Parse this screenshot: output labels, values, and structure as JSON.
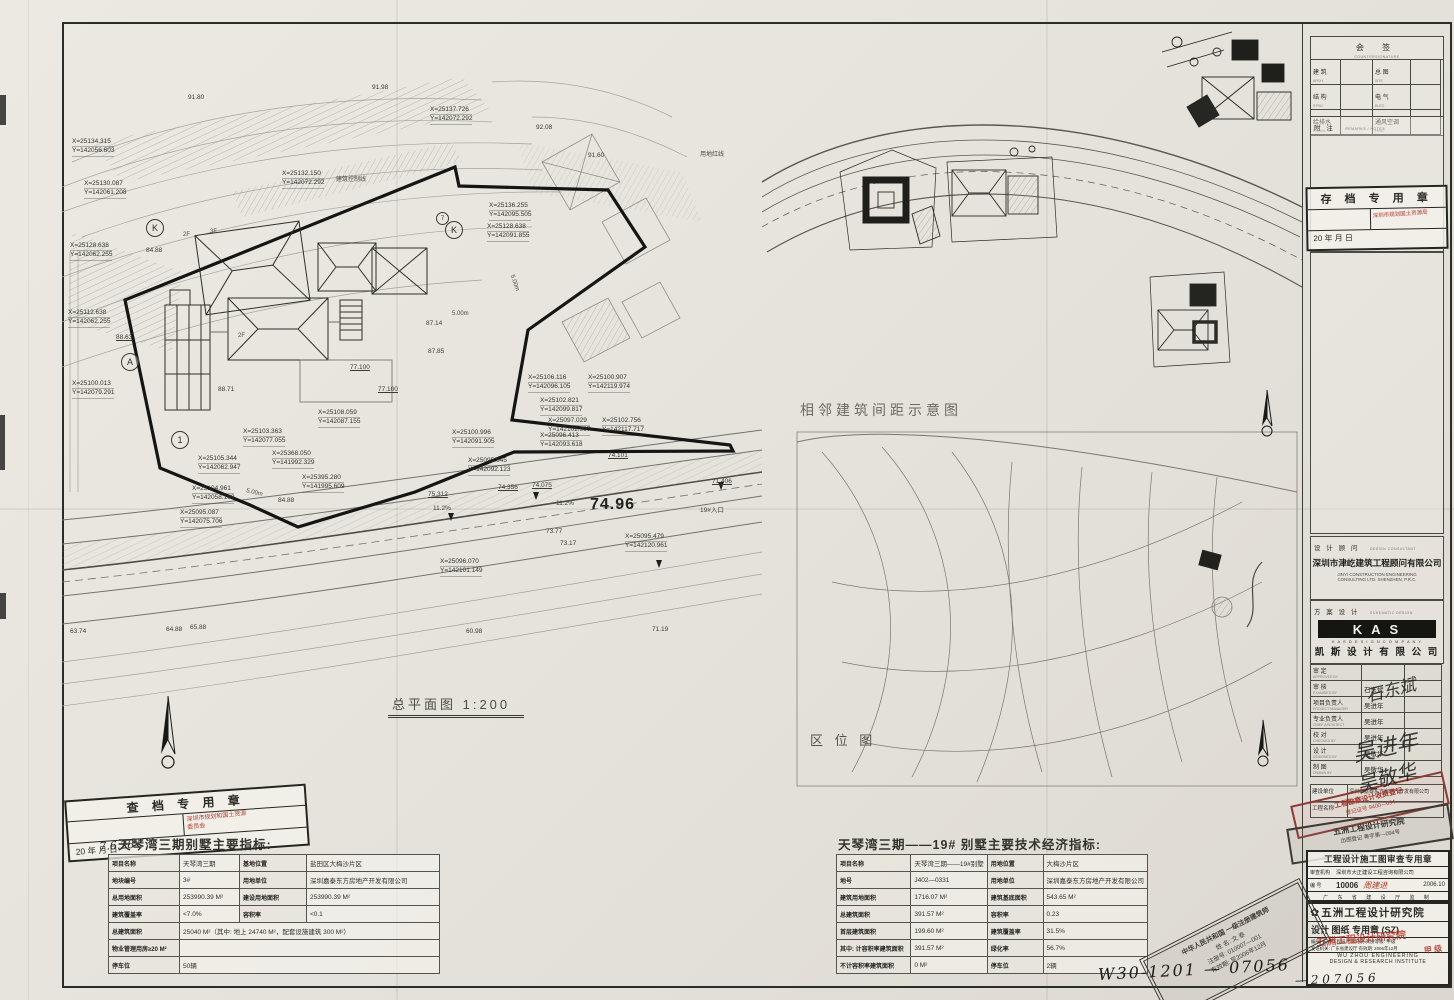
{
  "sheet": {
    "scale_label": "总平面图  1:200",
    "handwritten_drawing_no": "W30-1201 — 07056",
    "spacing_diagram_label": "相邻建筑间距示意图",
    "location_map_label": "区 位 图"
  },
  "main_plan": {
    "coord_labels": [
      {
        "x": 430,
        "y": 106,
        "l1": "X=25137.726",
        "l2": "Y=142072.292"
      },
      {
        "x": 72,
        "y": 138,
        "l1": "X=25134.315",
        "l2": "Y=142056.603"
      },
      {
        "x": 84,
        "y": 180,
        "l1": "X=25130.087",
        "l2": "Y=142061.208"
      },
      {
        "x": 282,
        "y": 170,
        "l1": "X=25132.150",
        "l2": "Y=142072.292"
      },
      {
        "x": 70,
        "y": 242,
        "l1": "X=25128.638",
        "l2": "Y=142062.255"
      },
      {
        "x": 489,
        "y": 202,
        "l1": "X=25136.255",
        "l2": "Y=142095.505"
      },
      {
        "x": 487,
        "y": 223,
        "l1": "X=25128.638",
        "l2": "Y=142091.855"
      },
      {
        "x": 68,
        "y": 309,
        "l1": "X=25112.638",
        "l2": "Y=142062.255"
      },
      {
        "x": 72,
        "y": 380,
        "l1": "X=25100.013",
        "l2": "Y=142079.291"
      },
      {
        "x": 318,
        "y": 409,
        "l1": "X=25108.059",
        "l2": "Y=142087.155"
      },
      {
        "x": 243,
        "y": 428,
        "l1": "X=25103.363",
        "l2": "Y=142077.055"
      },
      {
        "x": 198,
        "y": 455,
        "l1": "X=25105.344",
        "l2": "Y=142062.947"
      },
      {
        "x": 272,
        "y": 450,
        "l1": "X=25368.050",
        "l2": "Y=141992.329"
      },
      {
        "x": 302,
        "y": 474,
        "l1": "X=25395.280",
        "l2": "Y=141995.609"
      },
      {
        "x": 192,
        "y": 485,
        "l1": "X=25104.961",
        "l2": "Y=142058.199"
      },
      {
        "x": 180,
        "y": 509,
        "l1": "X=25095.087",
        "l2": "Y=142075.706"
      },
      {
        "x": 452,
        "y": 429,
        "l1": "X=25100.996",
        "l2": "Y=142091.905"
      },
      {
        "x": 468,
        "y": 457,
        "l1": "X=25095.645",
        "l2": "Y=142092.123"
      },
      {
        "x": 528,
        "y": 374,
        "l1": "X=25106.116",
        "l2": "Y=142096.105"
      },
      {
        "x": 588,
        "y": 374,
        "l1": "X=25100.907",
        "l2": "Y=142119.974"
      },
      {
        "x": 540,
        "y": 397,
        "l1": "X=25102.821",
        "l2": "Y=142099.817"
      },
      {
        "x": 548,
        "y": 417,
        "l1": "X=25097.029",
        "l2": "Y=142102.997"
      },
      {
        "x": 602,
        "y": 417,
        "l1": "X=25102.756",
        "l2": "Y=142117.717"
      },
      {
        "x": 540,
        "y": 432,
        "l1": "X=25096.413",
        "l2": "Y=142093.618"
      },
      {
        "x": 440,
        "y": 558,
        "l1": "X=25096.070",
        "l2": "Y=142101.149"
      },
      {
        "x": 625,
        "y": 533,
        "l1": "X=25095.479",
        "l2": "Y=142120.961"
      }
    ],
    "spot_elevations": [
      {
        "x": 188,
        "y": 94,
        "t": "91.80"
      },
      {
        "x": 372,
        "y": 84,
        "t": "91.98"
      },
      {
        "x": 536,
        "y": 124,
        "t": "92.08"
      },
      {
        "x": 588,
        "y": 152,
        "t": "91.60"
      },
      {
        "x": 116,
        "y": 334,
        "t": "88.63",
        "u": 1
      },
      {
        "x": 218,
        "y": 386,
        "t": "88.71"
      },
      {
        "x": 146,
        "y": 247,
        "t": "84.88"
      },
      {
        "x": 278,
        "y": 497,
        "t": "84.88"
      },
      {
        "x": 426,
        "y": 320,
        "t": "87.14"
      },
      {
        "x": 428,
        "y": 348,
        "t": "87.85"
      },
      {
        "x": 350,
        "y": 364,
        "t": "77.100",
        "u": 1
      },
      {
        "x": 378,
        "y": 386,
        "t": "77.100",
        "u": 1
      },
      {
        "x": 498,
        "y": 484,
        "t": "74.356",
        "u": 1
      },
      {
        "x": 532,
        "y": 482,
        "t": "74.075",
        "u": 1
      },
      {
        "x": 608,
        "y": 452,
        "t": "74.101",
        "u": 1
      },
      {
        "x": 428,
        "y": 491,
        "t": "75.312",
        "u": 1
      },
      {
        "x": 712,
        "y": 478,
        "t": "71.406",
        "u": 1
      },
      {
        "x": 433,
        "y": 505,
        "t": "11.2%"
      },
      {
        "x": 556,
        "y": 500,
        "t": "11.2%"
      },
      {
        "x": 700,
        "y": 504,
        "t": "19#入口"
      },
      {
        "x": 546,
        "y": 528,
        "t": "73.77"
      },
      {
        "x": 560,
        "y": 540,
        "t": "73.17"
      },
      {
        "x": 70,
        "y": 628,
        "t": "63.74"
      },
      {
        "x": 166,
        "y": 626,
        "t": "64.88"
      },
      {
        "x": 190,
        "y": 624,
        "t": "65.88"
      },
      {
        "x": 466,
        "y": 628,
        "t": "60.98"
      },
      {
        "x": 652,
        "y": 626,
        "t": "71.19"
      },
      {
        "x": 590,
        "y": 496,
        "t": "74.96",
        "big": 1
      }
    ],
    "misc_labels": [
      {
        "x": 336,
        "y": 174,
        "t": "建筑控制线"
      },
      {
        "x": 700,
        "y": 149,
        "t": "用地红线"
      },
      {
        "x": 506,
        "y": 280,
        "t": "5.00m",
        "rot": 70
      },
      {
        "x": 246,
        "y": 490,
        "t": "5.00m",
        "rot": 14
      },
      {
        "x": 452,
        "y": 311,
        "t": "5.00m"
      },
      {
        "x": 183,
        "y": 232,
        "t": "2F"
      },
      {
        "x": 210,
        "y": 229,
        "t": "3F"
      },
      {
        "x": 238,
        "y": 333,
        "t": "2F"
      }
    ],
    "grid_bubbles": [
      {
        "x": 146,
        "y": 219,
        "t": "K",
        "r": 16
      },
      {
        "x": 445,
        "y": 221,
        "t": "K",
        "r": 16
      },
      {
        "x": 436,
        "y": 212,
        "t": "7",
        "r": 11
      },
      {
        "x": 121,
        "y": 353,
        "t": "A",
        "r": 16
      },
      {
        "x": 171,
        "y": 431,
        "t": "1",
        "r": 16
      }
    ]
  },
  "left_table": {
    "title": "天琴湾三期别墅主要指标:",
    "rows": [
      {
        "cells": [
          {
            "t": "项目名称",
            "h": 1
          },
          {
            "t": "天琴湾三期"
          },
          {
            "t": "基地位置",
            "h": 1
          },
          {
            "t": "盐田区大梅沙片区"
          }
        ]
      },
      {
        "cells": [
          {
            "t": "地块编号",
            "h": 1
          },
          {
            "t": "3#"
          },
          {
            "t": "用地单位",
            "h": 1
          },
          {
            "t": "深圳嘉泰东方房地产开发有限公司"
          }
        ]
      },
      {
        "cells": [
          {
            "t": "总用地面积",
            "h": 1
          },
          {
            "t": "253990.39 M²"
          },
          {
            "t": "建设用地面积",
            "h": 1
          },
          {
            "t": "253990.39 M²"
          }
        ]
      },
      {
        "cells": [
          {
            "t": "建筑覆盖率",
            "h": 1
          },
          {
            "t": "<7.0%"
          },
          {
            "t": "容积率",
            "h": 1
          },
          {
            "t": "<0.1"
          }
        ]
      },
      {
        "cells": [
          {
            "t": "总建筑面积",
            "h": 1
          },
          {
            "t": "25040 M²（其中: 地上 24740 M²，配套设施建筑 300 M²）",
            "span": 3
          }
        ]
      },
      {
        "cells": [
          {
            "t": "物业管理用房≥20 M²",
            "h": 1
          },
          {
            "t": "",
            "span": 3
          }
        ]
      },
      {
        "cells": [
          {
            "t": "停车位",
            "h": 1
          },
          {
            "t": "50辆",
            "span": 3
          }
        ]
      }
    ]
  },
  "right_table": {
    "title": "天琴湾三期——19# 别墅主要技术经济指标:",
    "rows": [
      {
        "cells": [
          {
            "t": "项目名称",
            "h": 1
          },
          {
            "t": "天琴湾三期——19#别墅"
          },
          {
            "t": "用地位置",
            "h": 1
          },
          {
            "t": "大梅沙片区"
          }
        ]
      },
      {
        "cells": [
          {
            "t": "地号",
            "h": 1
          },
          {
            "t": "J402—0331"
          },
          {
            "t": "用地单位",
            "h": 1
          },
          {
            "t": "深圳嘉泰东方房地产开发有限公司"
          }
        ]
      },
      {
        "cells": [
          {
            "t": "建筑用地面积",
            "h": 1
          },
          {
            "t": "1716.07 M²"
          },
          {
            "t": "建筑基底面积",
            "h": 1
          },
          {
            "t": "543.65 M²"
          }
        ]
      },
      {
        "cells": [
          {
            "t": "总建筑面积",
            "h": 1
          },
          {
            "t": "391.57 M²"
          },
          {
            "t": "容积率",
            "h": 1
          },
          {
            "t": "0.23"
          }
        ]
      },
      {
        "cells": [
          {
            "t": "首层建筑面积",
            "h": 1
          },
          {
            "t": "199.60 M²"
          },
          {
            "t": "建筑覆盖率",
            "h": 1
          },
          {
            "t": "31.5%"
          }
        ]
      },
      {
        "cells": [
          {
            "t": "其中: 计容积率建筑面积",
            "h": 1
          },
          {
            "t": "391.57 M²"
          },
          {
            "t": "绿化率",
            "h": 1
          },
          {
            "t": "56.7%"
          }
        ]
      },
      {
        "cells": [
          {
            "t": "不计容积率建筑面积",
            "h": 1
          },
          {
            "t": "0 M²"
          },
          {
            "t": "停车位",
            "h": 1
          },
          {
            "t": "2辆"
          }
        ]
      }
    ]
  },
  "check_stamp": {
    "title": "查 档 专 用 章",
    "red_line1": "深圳市规划和国土资源",
    "red_line2": "委员会",
    "date_line": "20    年    月    日",
    "handwritten_date": "7.6.28"
  },
  "titleblock": {
    "countersign": {
      "title": "会      签",
      "subtitle": "COUNTERSIGNATURE",
      "cells": [
        {
          "l": "建 筑",
          "s": "ARCH."
        },
        {
          "l": "总 图",
          "s": "SITE"
        },
        {
          "l": "结 构",
          "s": "STRU."
        },
        {
          "l": "电 气",
          "s": "ELEC."
        },
        {
          "l": "给排水",
          "s": "PLUMB."
        },
        {
          "l": "通风空调",
          "s": "HVAC"
        }
      ]
    },
    "notes": {
      "title": "附  注",
      "subtitle": "REMARKS / NOTES"
    },
    "archive_stamp": {
      "title": "存 档 专 用 章",
      "red_text": "深圳市规划国土资源局",
      "date_line": "20    年    月    日"
    },
    "design_consultant": {
      "header": "设 计 顾 问",
      "header_sub": "DESIGN CONSULTANT",
      "company_cn": "深圳市津屹建筑工程顾问有限公司",
      "company_en1": "JINYI  CONSTRUCTION  ENGINEERING",
      "company_en2": "CONSULTING  LTD.    SHENZHEN,    P.R.C."
    },
    "scheme_design": {
      "header": "方 案 设 计",
      "header_sub": "SCHEMATIC DESIGN",
      "logo_letters": "KAS",
      "logo_text": "K A S    D E S I G N    C O M P A N Y",
      "company_cn": "凯 斯 设 计 有 限 公 司"
    },
    "signatures": [
      {
        "label": "审  定",
        "sub": "APPROVED BY",
        "name": ""
      },
      {
        "label": "审  核",
        "sub": "EXAMINED BY",
        "name": "石东斌"
      },
      {
        "label": "项目负责人",
        "sub": "PROJECT MANAGER",
        "name": "吴进年"
      },
      {
        "label": "专业负责人",
        "sub": "CHIEF ARCHITECT",
        "name": "吴进年"
      },
      {
        "label": "校  对",
        "sub": "CHECKED BY",
        "name": "吴进年"
      },
      {
        "label": "设  计",
        "sub": "DESIGNED BY",
        "name": "吴敬华"
      },
      {
        "label": "制  图",
        "sub": "DRAWN BY",
        "name": "吴敬华"
      }
    ],
    "signature_overlays": [
      {
        "t": "石东斌",
        "x": 1365,
        "y": 676,
        "rot": -14,
        "size": 17
      },
      {
        "t": "吴进年",
        "x": 1352,
        "y": 730,
        "rot": -12,
        "size": 22
      },
      {
        "t": "吴敬华",
        "x": 1356,
        "y": 762,
        "rot": -15,
        "size": 20
      }
    ],
    "client_row": {
      "label": "建设单位",
      "value": "深圳市嘉泰东方房地产开发有限公司"
    },
    "project_row": {
      "label": "工程名称",
      "value": ""
    },
    "fee_stamp": {
      "line1": "工程勘察设计收费登记",
      "line2": "登记证号 9400—094"
    },
    "institute_stamp": {
      "line1": "五洲工程设计研究院",
      "line2": "出图登记  粤字第—094号"
    },
    "review_stamp": {
      "title": "工程设计施工图审查专用章",
      "agency_label": "审查机构",
      "agency": "深圳市大正建设工程咨询有限公司",
      "no_label": "编  号",
      "no": "10006",
      "handwritten": "周建进",
      "date": "2006.10",
      "footer": "广 东 省 建 设 厅 监 制"
    },
    "wuzhou": {
      "logo_glyph": "✿",
      "title": "五洲工程设计研究院",
      "line1": "设计  图纸  专用章 (SZ)",
      "red_overlay1": "五洲工程设计研究院",
      "red_overlay2": "甲 级",
      "line2": "编号: 五洲工程设计研究院   资质等级: 甲级",
      "line3": "发证机关: 广东省建设厅   有效期: 2006年12月",
      "en1": "WU ZHOU ENGINEERING",
      "en2": "DESIGN & RESEARCH INSTITUTE",
      "handwritten_no": "— 2   0 7 0 5 6"
    },
    "architect_stamp": {
      "line1": "中华人民共和国 一级注册建筑师",
      "name": "姓  名:  文 泰",
      "reg": "注册号:  010007—001",
      "valid": "有效期:  至2006年12月"
    }
  }
}
